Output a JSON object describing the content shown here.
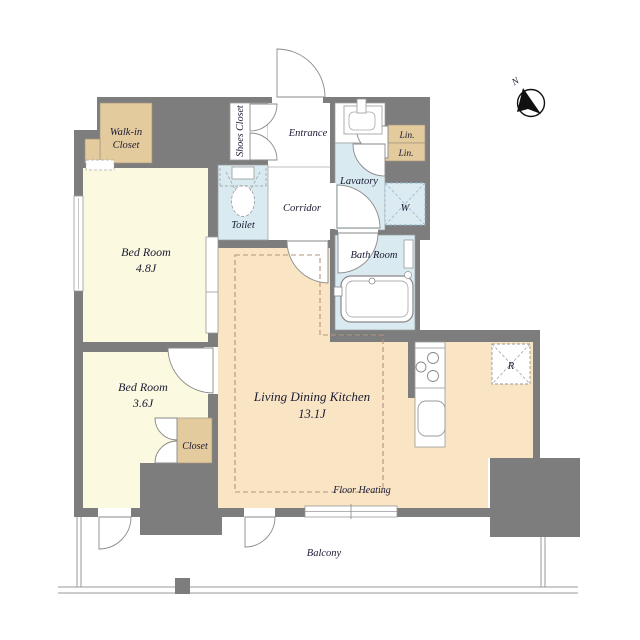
{
  "floor_plan": {
    "compass": {
      "north_label": "N"
    },
    "rooms": {
      "walk_in_closet": {
        "line1": "Walk-in",
        "line2": "Closet"
      },
      "bedroom_1": {
        "name": "Bed Room",
        "size": "4.8J"
      },
      "bedroom_2": {
        "name": "Bed Room",
        "size": "3.6J"
      },
      "shoes_closet": {
        "name": "Shoes Closet"
      },
      "entrance": {
        "name": "Entrance"
      },
      "toilet": {
        "name": "Toilet"
      },
      "corridor": {
        "name": "Corridor"
      },
      "lavatory": {
        "name": "Lavatory"
      },
      "linen_upper": {
        "name": "Lin."
      },
      "linen_lower": {
        "name": "Lin."
      },
      "bath_room": {
        "name": "Bath Room"
      },
      "living_dining_kitchen": {
        "name": "Living Dining Kitchen",
        "size": "13.1J"
      },
      "closet": {
        "name": "Closet"
      },
      "balcony": {
        "name": "Balcony"
      }
    },
    "annotations": {
      "floor_heating": "Floor Heating",
      "washing_machine": "W",
      "refrigerator": "R"
    },
    "colors": {
      "wall": "#7d7d7d",
      "bedroom_fill": "#fcf9e1",
      "closet_fill": "#e4cb9e",
      "wet_area_fill": "#d9eaf0",
      "ldk_fill": "#f9e4c4",
      "floor_heating_dash": "#b5937c",
      "label_text": "#1a1a33"
    }
  }
}
